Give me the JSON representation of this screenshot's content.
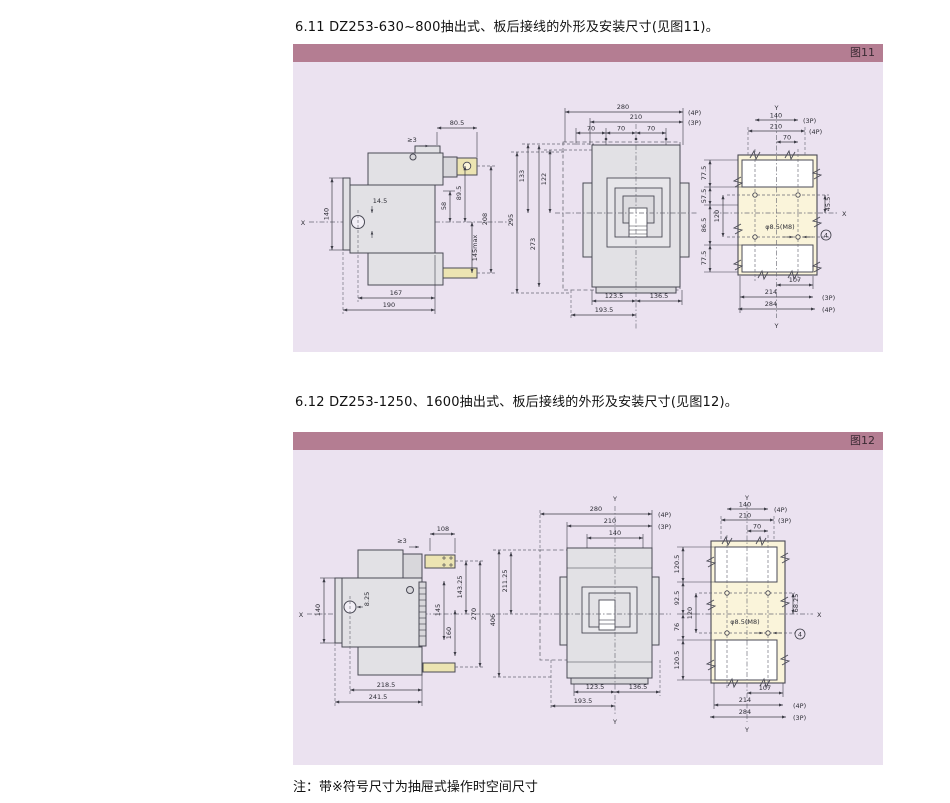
{
  "page": {
    "section1_title": "6.11 DZ253-630~800抽出式、板后接线的外形及安装尺寸(见图11)。",
    "section2_title": "6.12 DZ253-1250、1600抽出式、板后接线的外形及安装尺寸(见图12)。",
    "note": "注：带※符号尺寸为抽屉式操作时空间尺寸"
  },
  "colors": {
    "header_bar": "#b47d92",
    "panel_bg": "#ebe2f0",
    "plate_fill": "#faf4da",
    "terminal_fill": "#ece4b2",
    "body_fill": "#e2e1e5"
  },
  "fig11": {
    "tag": "图11",
    "side": {
      "x": "X",
      "d80_5": "80.5",
      "ge3": "≥3",
      "d140": "140",
      "d14_5": "14.5",
      "d58": "58",
      "d89_5": "89.5",
      "d145max": "145max",
      "d208": "208",
      "d167": "167",
      "d190": "190"
    },
    "mid": {
      "d295": "295",
      "d133": "133",
      "d273": "273",
      "d122": "122"
    },
    "front": {
      "d280": "280",
      "p4": "(4P)",
      "d210": "210",
      "p3": "(3P)",
      "d70a": "70",
      "d70b": "70",
      "d70c": "70",
      "d123_5": "123.5",
      "d136_5": "136.5",
      "d193_5": "193.5"
    },
    "cut": {
      "y_top": "Y",
      "y_bot": "Y",
      "x": "X",
      "d140": "140",
      "p3": "(3P)",
      "d210": "210",
      "p4": "(4P)",
      "d70": "70",
      "d77_5a": "77.5",
      "d57_5": "57.5",
      "d86_5": "86.5",
      "d120": "120",
      "d77_5b": "77.5",
      "d45_5": "45.5",
      "hole": "φ8.5(M8)",
      "qty": "4",
      "d107": "107",
      "d214": "214",
      "p3b": "(3P)",
      "d284": "284",
      "p4b": "(4P)"
    }
  },
  "fig12": {
    "tag": "图12",
    "side": {
      "x": "X",
      "d108": "108",
      "ge3": "≥3",
      "d140": "140",
      "d8_25": "8.25",
      "d145": "145",
      "d160": "160",
      "d143_25": "143.25",
      "d270": "270",
      "d218_5": "218.5",
      "d241_5": "241.5"
    },
    "mid": {
      "d406": "406",
      "d211_25": "211.25"
    },
    "front": {
      "y_top": "Y",
      "y_bot": "Y",
      "d280": "280",
      "p4": "(4P)",
      "d210": "210",
      "p3": "(3P)",
      "d140": "140",
      "d123_5": "123.5",
      "d136_5": "136.5",
      "d193_5": "193.5"
    },
    "cut": {
      "y_top": "Y",
      "y_bot": "Y",
      "x": "X",
      "d140": "140",
      "p4": "(4P)",
      "d210": "210",
      "p3": "(3P)",
      "d70": "70",
      "d120_5a": "120.5",
      "d92_5": "92.5",
      "d76": "76",
      "d120": "120",
      "d120_5b": "120.5",
      "d68_25": "68.25",
      "hole": "φ8.5(M8)",
      "qty": "4",
      "d107": "107",
      "d214": "214",
      "p4b": "(4P)",
      "d284": "284",
      "p3b": "(3P)"
    }
  }
}
